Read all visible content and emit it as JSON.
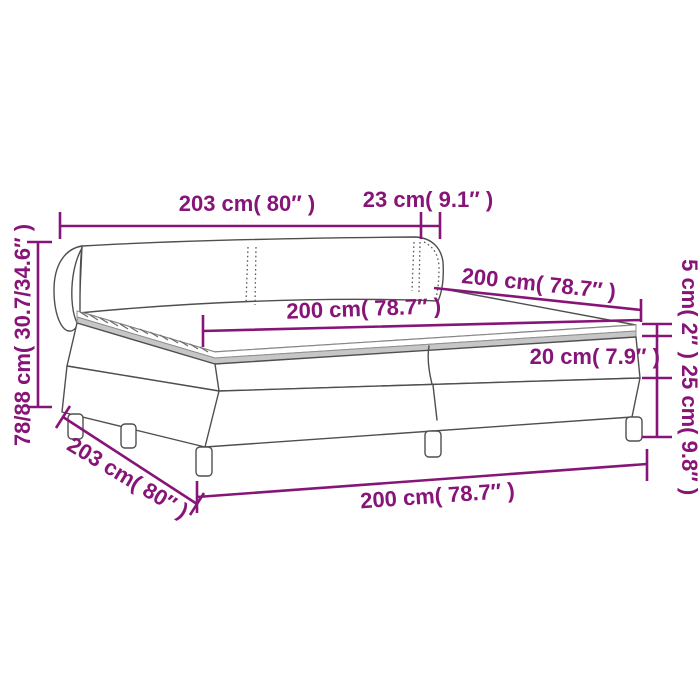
{
  "diagram": {
    "product": "box-spring-bed-with-headboard",
    "accent_color": "#871578",
    "artwork_color": "#4f4f4f",
    "background_color": "#ffffff",
    "labels": {
      "headboard_width_top": "203 cm( 80″ )",
      "headboard_side_depth": "23 cm( 9.1″ )",
      "headboard_height_left": "78/88 cm( 30.7/34.6″ )",
      "mattress_length_surface": "200 cm( 78.7″ )",
      "bed_width_rear": "200 cm( 78.7″ )",
      "topper_thickness": "5 cm( 2″ )",
      "mattress_thickness": "20 cm( 7.9″ )",
      "base_height": "25 cm( 9.8″ )",
      "base_width_diagonal": "203 cm( 80″ )",
      "base_length_bottom": "200 cm( 78.7″ )"
    }
  }
}
